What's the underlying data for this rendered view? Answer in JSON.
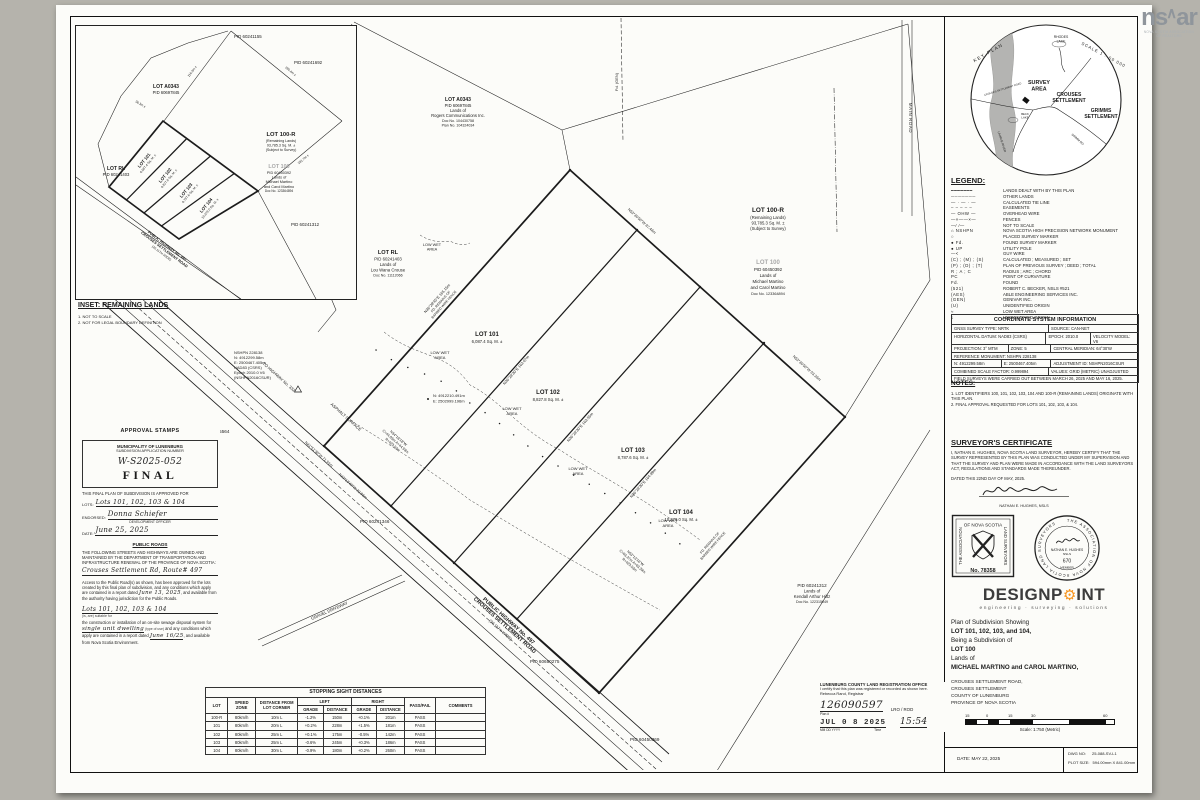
{
  "watermark": {
    "left": "ns",
    "right": "ar",
    "sub1": "NOVA SCOTIA ASSOCIATION",
    "sub2": "OF REALTORS"
  },
  "keyplan": {
    "title": "KEY PLAN",
    "scale": "SCALE 1 : 50 000",
    "labels": {
      "lake1a": "RHODES",
      "lake1b": "LAKE",
      "survey1": "SURVEY",
      "survey2": "AREA",
      "crouses1": "CROUSES",
      "crouses2": "SETTLEMENT",
      "grimms1": "GRIMMS",
      "grimms2": "SETTLEMENT",
      "road": "CROUSES SETTLEMENT ROAD",
      "beck1": "BECK",
      "beck2": "LAKE",
      "grimmrd": "GRIMM RD",
      "river": "LAHAVE RIVER"
    }
  },
  "inset": {
    "heading": "INSET: REMAINING LANDS",
    "note1": "1. NOT TO SCALE",
    "note2": "2. NOT FOR LEGAL BOUNDARY DEFINITION",
    "pid1": "PID 60241155",
    "pid2": "PID 60241692",
    "pid3": "PID 60241312",
    "a0343": [
      "LOT A0343",
      "PID 60697845"
    ],
    "rl": [
      "LOT RL",
      "PID 60241403"
    ],
    "r100": [
      "LOT 100-R",
      "(Remaining Lands)",
      "93,785.3 Sq. M. ±",
      "(Subject to Survey)"
    ],
    "l100": [
      "LOT 100",
      "PID 60450392",
      "Lands of",
      "Michael Martino",
      "and Carol Martino",
      "Doc No. 123364894"
    ],
    "lots": [
      [
        "LOT 101",
        "6,087.4 Sq. M. ±"
      ],
      [
        "LOT 102",
        "8,827.8 Sq. M. ±"
      ],
      [
        "LOT 103",
        "8,787.6 Sq. M. ±"
      ],
      [
        "LOT 104",
        "10,378.0 Sq. M. ±"
      ]
    ],
    "road": [
      "PUBLIC HIGHWAY No. 497",
      "CROUSES SETTLEMENT ROAD",
      "(20.117m WIDE)"
    ],
    "dims": [
      "116.3m ±",
      "36.3m ±",
      "280.4m ±",
      "281.7m ±"
    ]
  },
  "legend": {
    "title": "LEGEND:",
    "rows": [
      {
        "s": "━━━━━━━",
        "t": "LANDS DEALT WITH BY THIS PLAN"
      },
      {
        "s": "───────",
        "t": "OTHER LANDS"
      },
      {
        "s": "— · — · —",
        "t": "CALCULATED TIE LINE"
      },
      {
        "s": "– – – – –",
        "t": "EASEMENTS"
      },
      {
        "s": "— OHW —",
        "t": "OVERHEAD WIRE"
      },
      {
        "s": "—×——×—",
        "t": "FENCES"
      },
      {
        "s": "—∕ ∕—",
        "t": "NOT TO SCALE"
      },
      {
        "s": "⌂ NSHPN",
        "t": "NOVA SCOTIA HIGH PRECISION NETWORK MONUMENT"
      },
      {
        "s": "○",
        "t": "PLACED SURVEY MARKER"
      },
      {
        "s": "● Fd.",
        "t": "FOUND SURVEY MARKER"
      },
      {
        "s": "● UP",
        "t": "UTILITY POLE"
      },
      {
        "s": "—<",
        "t": "GUY WIRE"
      },
      {
        "s": "(C) ; (M) ; (S)",
        "t": "CALCULATED ; MEASURED ; SET"
      },
      {
        "s": "(P) ; (D) ; (T)",
        "t": "PLAN OF PREVIOUS SURVEY ; DEED ; TOTAL"
      },
      {
        "s": "R ; A ; C",
        "t": "RADIUS ; ARC ; CHORD"
      },
      {
        "s": "PC",
        "t": "POINT OF CURVATURE"
      },
      {
        "s": "Fd.",
        "t": "FOUND"
      },
      {
        "s": "(521)",
        "t": "ROBERT C. BECKER, NSLS #521"
      },
      {
        "s": "(AES)",
        "t": "ABLE ENGINEERING SERVICES INC."
      },
      {
        "s": "(GEN)",
        "t": "GENIVAR INC."
      },
      {
        "s": "(U)",
        "t": "UNIDENTIFIED ORIGIN"
      },
      {
        "s": "≈",
        "t": "LOW WET AREA"
      },
      {
        "s": "ɛ",
        "t": "UNIDENTIFIED ORIGIN"
      }
    ]
  },
  "coord": {
    "title": "COORDINATE SYSTEM INFORMATION",
    "rows": [
      [
        {
          "t": "GNSS SURVEY TYPE:  NRTK",
          "w": 52
        },
        {
          "t": "SOURCE:  CAN-NET",
          "w": 48
        }
      ],
      [
        {
          "t": "HORIZONTAL DATUM:  NAD83 (CSRS)",
          "w": 52
        },
        {
          "t": "EPOCH:  2010.0",
          "w": 23
        },
        {
          "t": "VELOCITY MODEL:  V6",
          "w": 25
        }
      ],
      [
        {
          "t": "PROJECTION:  3° MTM",
          "w": 30
        },
        {
          "t": "ZONE:  5",
          "w": 22
        },
        {
          "t": "CENTRAL MERIDIAN:  64°30'W",
          "w": 48
        }
      ],
      [
        {
          "t": "REFERENCE MONUMENT:  NSHPN 228138",
          "w": 100
        }
      ],
      [
        {
          "t": "N: 4912299.58m",
          "w": 26
        },
        {
          "t": "E: 2500467.405m",
          "w": 26
        },
        {
          "t": "ADJUSTMENT ID: NSHPN2016CSUR",
          "w": 48
        }
      ],
      [
        {
          "t": "COMBINED SCALE FACTOR:  0.999894",
          "w": 52
        },
        {
          "t": "VALUES:  GRID (METRIC) UNADJUSTED",
          "w": 48
        }
      ],
      [
        {
          "t": "FIELD SURVEYS WERE CARRIED OUT BETWEEN MARCH 26, 2025 AND MAY 16, 2025.",
          "w": 100
        }
      ]
    ]
  },
  "notes": {
    "title": "NOTES:",
    "items": [
      "1. LOT IDENTIFIERS 100, 101, 102, 103, 104 AND 100-R (REMAINING LANDS) ORIGINATE WITH THIS PLAN.",
      "2. FINAL APPROVAL REQUESTED FOR LOTS 101, 102, 103, & 104."
    ]
  },
  "surveyor": {
    "heading": "SURVEYOR'S CERTIFICATE",
    "body": "I, NATHAN E. HUGHES, NOVA SCOTIA LAND SURVEYOR, HEREBY CERTIFY THAT THE SURVEY REPRESENTED BY THIS PLAN WAS CONDUCTED UNDER MY SUPERVISION AND THAT THE SURVEY AND PLAN WERE MADE IN ACCORDANCE WITH THE LAND SURVEYORS ACT, REGULATIONS AND STANDARDS MADE THEREUNDER.",
    "dated": "DATED THIS 22ND DAY OF MAY, 2025.",
    "sig_name": "NATHAN E. HUGHES, NSLS",
    "stamp_top": "OF NOVA SCOTIA",
    "stamp_left": "THE ASSOCIATION",
    "stamp_right": "LAND SURVEYORS",
    "stamp_no": "No. 78358",
    "seal_text": "THE ASSOCIATION OF NOVA SCOTIA LAND SURVEYORS",
    "seal_name": "NATHAN E. HUGHES",
    "seal_nsls": "NSLS",
    "seal_num": "670",
    "seal_member": "MEMBER"
  },
  "registration": {
    "office": "LUNENBURG COUNTY LAND REGISTRATION OFFICE",
    "certify": "I certify that this plan was registered or recorded as shown here.",
    "registrar": "Rebecca Rand, Registrar",
    "plan_label": "Plan #",
    "plan_no": "126090597",
    "lro": "LRO / ROD",
    "stamp_date": "JUL 0 8 2025",
    "date_format": "MM  DD  YYYY",
    "time": "15:54",
    "time_label": "Time"
  },
  "titleblock": {
    "brand_left": "DESIGNP",
    "brand_right": "INT",
    "gear": "⚙",
    "tagline": "engineering · surveying · solutions",
    "line1": "Plan of Subdivision Showing",
    "line2": "LOT 101, 102, 103, and 104,",
    "line3": "Being a Subdivision of",
    "line4": "LOT 100",
    "line5": "Lands of",
    "line6": "MICHAEL MARTINO and CAROL MARTINO,",
    "addr": [
      "CROUSES SETTLEMENT ROAD,",
      "CROUSES SETTLEMENT",
      "COUNTY OF LUNENBURG",
      "PROVINCE OF NOVA SCOTIA"
    ],
    "scale_ticks": [
      "15",
      "0",
      "15",
      "30",
      "60"
    ],
    "scale_caption": "Scale: 1:750 (Metric)",
    "dwg_label": "DWG NO:",
    "dwg": "25-088-SV-L1",
    "plot_label": "PLOT SIZE:",
    "plot": "594.00mm X 841.00mm",
    "date": "DATE: MAY 22, 2025"
  },
  "approval": {
    "heading": "APPROVAL STAMPS",
    "box1": "MUNICIPALITY OF LUNENBURG",
    "box2": "SUBDIVISION APPLICATION NUMBER",
    "app_no": "W-S2025-052",
    "final": "FINAL",
    "approved_for": "THIS FINAL PLAN OF SUBDIVISION IS APPROVED FOR",
    "lots_label": "LOTS:",
    "lots_value": "Lots 101, 102, 103 & 104",
    "endorsed_label": "ENDORSED:",
    "endorsed_value": "Donna Schiefer",
    "endorsed_sub": "DEVELOPMENT OFFICER",
    "date_label": "DATE:",
    "date_value": "June 25, 2025",
    "roads_heading": "PUBLIC ROADS",
    "roads_para": "THE FOLLOWING STREETS AND HIGHWAYS ARE OWNED AND MAINTAINED BY THE DEPARTMENT OF TRANSPORTATION AND INFRASTRUCTURE RENEWAL OF THE PROVINCE OF NOVA SCOTIA:",
    "roads_value": "Crouses Settlement Rd, Route# 497",
    "access_1": "Access to the Public Road(s) as shown, has been approved for the lots created by this final plan of subdivision, and any conditions which apply are contained in a report dated",
    "access_date": "June 13, 2025",
    "access_2": ", and available from the authority having jurisdiction for the Public Roads.",
    "sewage_lots": "Lots 101, 102, 103 & 104",
    "sewage_suffix": "(is, are) suitable for",
    "sewage_para1": "the construction or installation of an on-site sewage disposal system for",
    "sewage_type": "single unit dwelling",
    "sewage_type_sub": "(type of use)",
    "sewage_para2": "and any conditions which apply are contained in a report dated",
    "sewage_date": "June 16/25",
    "sewage_para3": ", and available from Nova Scotia Environment."
  },
  "sight_table": {
    "title": "STOPPING SIGHT DISTANCES",
    "h_lot": "LOT",
    "h_speed": "SPEED ZONE",
    "h_dist": "DISTANCE FROM LOT CORNER",
    "h_left": "LEFT",
    "h_right": "RIGHT",
    "h_grade": "GRADE",
    "h_distance": "DISTANCE",
    "h_pass": "PASS/FAIL",
    "h_comments": "COMMENTS",
    "rows": [
      [
        "100-R",
        "80km/h",
        "10m L",
        "-1.2%",
        "150m",
        "+0.1%",
        "201m",
        "PASS",
        ""
      ],
      [
        "101",
        "80km/h",
        "20m L",
        "+0.2%",
        "228m",
        "+1.5%",
        "181m",
        "PASS",
        ""
      ],
      [
        "102",
        "80km/h",
        "25m L",
        "+0.1%",
        "175m",
        "-0.5%",
        "142m",
        "PASS",
        ""
      ],
      [
        "103",
        "80km/h",
        "25m L",
        "-0.6%",
        "245m",
        "+0.3%",
        "186m",
        "PASS",
        ""
      ],
      [
        "104",
        "80km/h",
        "30m L",
        "-0.9%",
        "180m",
        "+0.2%",
        "260m",
        "PASS",
        ""
      ]
    ]
  },
  "plan": {
    "lots": [
      {
        "name": "LOT 101",
        "area": "6,087.4 Sq. M. ±"
      },
      {
        "name": "LOT 102",
        "area": "8,827.8 Sq. M. ±"
      },
      {
        "name": "LOT 103",
        "area": "8,787.6 Sq. M. ±"
      },
      {
        "name": "LOT 104",
        "area": "10,378.0 Sq. M. ±"
      }
    ],
    "wet1": "LOW  WET",
    "wet2": "AREA",
    "lot100r": [
      "LOT 100-R",
      "(Remaining Lands)",
      "93,785.3 Sq. M. ±",
      "(Subject to Survey)"
    ],
    "lot100": [
      "LOT 100",
      "PID 60450392",
      "Lands of",
      "Michael Martino",
      "and Carol Martino",
      "Doc No. 123364894"
    ],
    "lotrl": [
      "LOT RL",
      "PID 60241403",
      "Lands of",
      "Lou Wana Crouse",
      "Doc No. 11112066"
    ],
    "lota0343": [
      "LOT A0343",
      "PID 60697845",
      "Lands of",
      "Rogers Communications Inc.",
      "Doc No. 104430758",
      "Plan No. 104324034"
    ],
    "hiltz": [
      "PID 60241312",
      "Lands of",
      "Kendall Arthur Hiltz",
      "Doc No. 122315049"
    ],
    "pids": {
      "p1": "PID 60615564",
      "p2": "PID 60241346",
      "p3": "PID 60650275",
      "p4": "PID 60450369"
    },
    "road": [
      "PUBLIC HIGHWAY No. 497",
      "CROUSES SETTLEMENT ROAD",
      "(20.117m WIDE)"
    ],
    "road_misc": {
      "asphalt": "ASPHALT SURFACE",
      "tohwy": "TO HIGHWAY No. 332",
      "gravel": "GRAVEL DRIVEWAY",
      "main": "MAIN ROAD",
      "fdgen": "Fd. (GEN)"
    },
    "monument": [
      "NSHPN 228138",
      "N: 4912299.58m",
      "E: 2500467.405m",
      "NAD83 (CSRS)",
      "Epoch 2010.0 V6",
      "(NSHPN2016CSUR)"
    ],
    "pt": [
      "N: 4912210.491m",
      "E: 2502999.196m"
    ],
    "curve1": [
      "N34°18'18\"W",
      "C=44.93m  A=44.93m",
      "R=423.53m"
    ],
    "curve2": [
      "N53°13'16\"W",
      "C=63.27m  A=63.29m",
      "R=423.53m"
    ],
    "bearing_left": [
      "N36°29'45\"E  165.15m",
      "FD. REMAINS OF",
      "BARBED WIRE FENCE"
    ],
    "div1": "N36°28'30\"E  162.07m",
    "div2": "N36°28'30\"E  163.55m",
    "div3": "N36°28'30\"E  164.89m",
    "top1": "N53°30'50\"W  87.44m",
    "top2": "N53°30'50\"W  63.36m",
    "front1": "N41°51'30\"W  71.91m",
    "front2": "N43°13'40\"W  22.86m",
    "fence2": [
      "FD. REMAINS OF",
      "BARBED WIRE FENCE"
    ]
  }
}
